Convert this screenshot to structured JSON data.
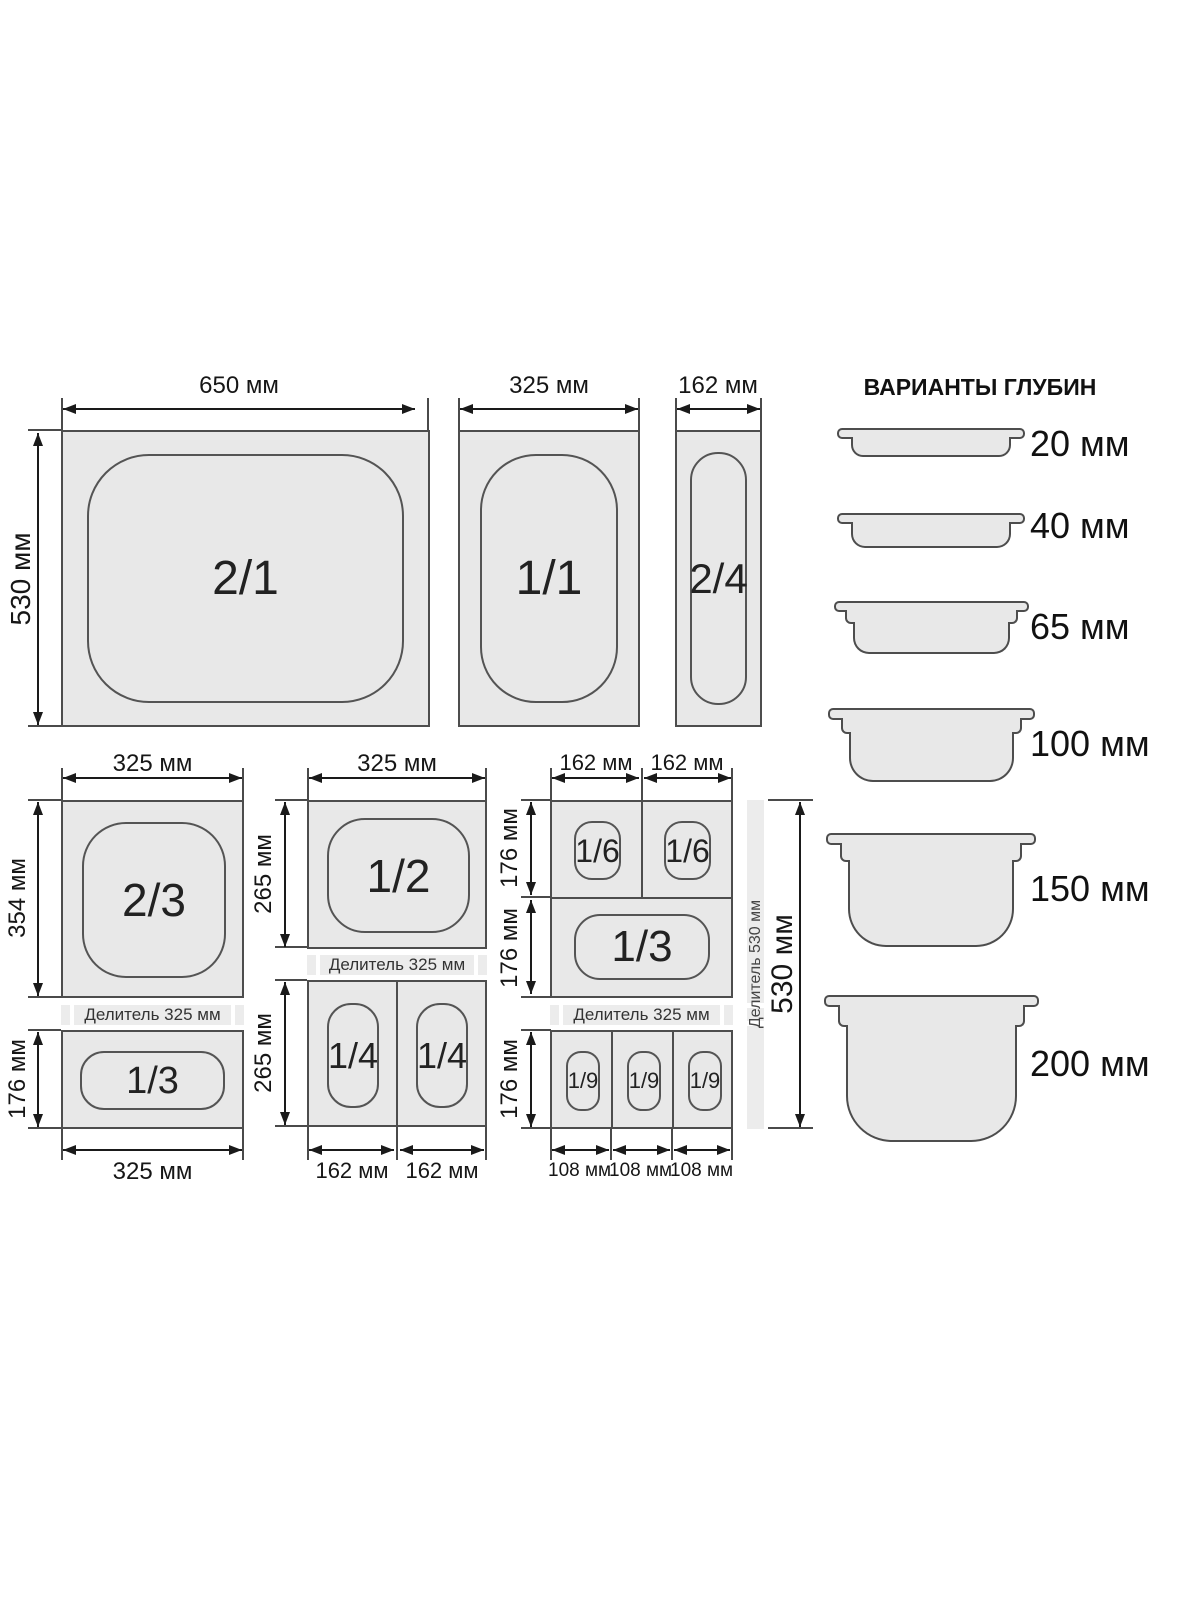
{
  "colors": {
    "fill": "#e8e8e8",
    "stroke": "#4d4d4d",
    "dim_line": "#1a1a1a",
    "strip": "#ececec",
    "background": "#ffffff"
  },
  "top": {
    "pan21": {
      "label": "2/1",
      "width_dim": "650 мм",
      "height_dim": "530 мм"
    },
    "pan11": {
      "label": "1/1",
      "width_dim": "325 мм"
    },
    "pan24": {
      "label": "2/4",
      "width_dim": "162 мм"
    }
  },
  "col1": {
    "top_dim": "325 мм",
    "pan23": {
      "label": "2/3",
      "side_dim": "354 мм"
    },
    "divider": "Делитель 325 мм",
    "pan13": {
      "label": "1/3",
      "side_dim": "176 мм"
    },
    "bottom_dim": "325 мм"
  },
  "col2": {
    "top_dim": "325 мм",
    "pan12": {
      "label": "1/2",
      "side_dim": "265 мм"
    },
    "divider": "Делитель 325 мм",
    "pan14": {
      "labels": [
        "1/4",
        "1/4"
      ],
      "side_dim": "265 мм"
    },
    "bottom_dims": [
      "162 мм",
      "162 мм"
    ]
  },
  "col3": {
    "top_dims": [
      "162 мм",
      "162 мм"
    ],
    "pan16": {
      "labels": [
        "1/6",
        "1/6"
      ],
      "side_dim": "176 мм"
    },
    "pan13": {
      "label": "1/3",
      "side_dim": "176 мм"
    },
    "divider": "Делитель 325 мм",
    "pan19": {
      "labels": [
        "1/9",
        "1/9",
        "1/9"
      ],
      "side_dim": "176 мм"
    },
    "bottom_dims": [
      "108 мм",
      "108 мм",
      "108 мм"
    ],
    "vertical_divider": "Делитель 530 мм",
    "height_dim": "530 мм"
  },
  "depths": {
    "title": "ВАРИАНТЫ ГЛУБИН",
    "items": [
      "20 мм",
      "40 мм",
      "65 мм",
      "100 мм",
      "150 мм",
      "200 мм"
    ]
  }
}
